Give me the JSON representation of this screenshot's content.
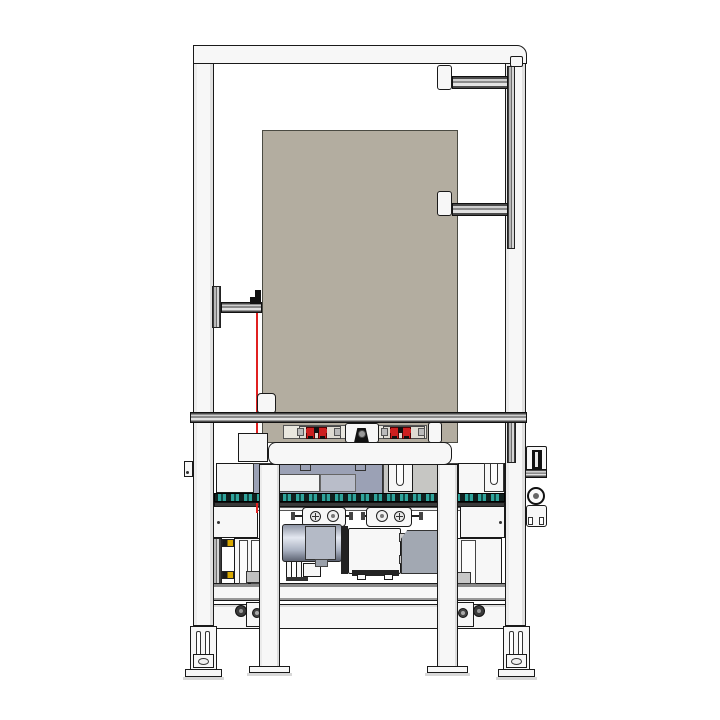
{
  "colors": {
    "line": "#1a1a1a",
    "frame_fill": "#f7f7f7",
    "panel_beige": "#b3ada0",
    "accent_red": "#e02020",
    "clamp_red": "#cc1f1f",
    "chain_teal": "#2fa39b",
    "housing_slate": "#9ba1b5",
    "motor_steel": "#aab2c2",
    "warning_yellow": "#d8a800",
    "shadow_gray": "#d8d8d8"
  }
}
